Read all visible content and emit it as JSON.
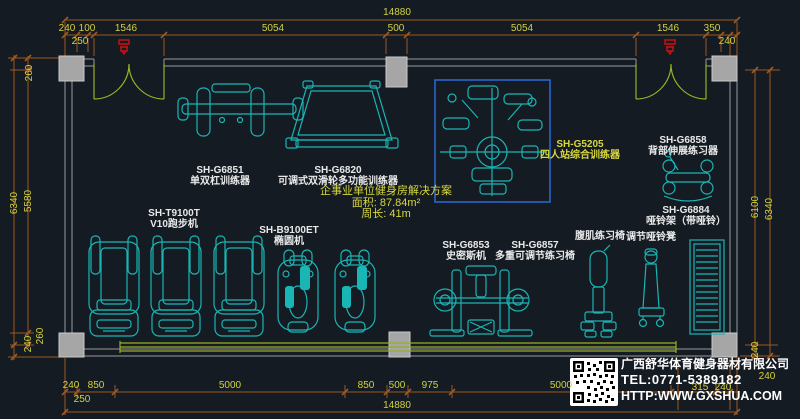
{
  "title": "企事业单位健身房平面布置图",
  "colors": {
    "bg": "#141b22",
    "cyan": "#1ab5b5",
    "green": "#96b124",
    "dimline": "#9e5a20",
    "dimtext": "#d2d23e",
    "wall": "#9a9a9a",
    "wallfill": "#a6a6a6",
    "blue": "#2b6bd7",
    "red": "#cc1111",
    "white": "#e9e9e9",
    "yellow": "#d8d83e"
  },
  "dims": {
    "top_total": "14880",
    "top_row": [
      "240",
      "100",
      "1546",
      "5054",
      "500",
      "5054",
      "1546",
      "350"
    ],
    "top_sub": [
      "250",
      "240"
    ],
    "left": [
      "260",
      "6340",
      "5580",
      "240",
      "260"
    ],
    "right": [
      "6100",
      "6340",
      "240",
      "240"
    ],
    "bottom_row": [
      "240",
      "850",
      "5000",
      "850",
      "500",
      "975",
      "5000",
      "315",
      "240"
    ],
    "bottom_sub": [
      "250"
    ],
    "bottom_total": "14880"
  },
  "solution": {
    "title": "企事业单位健身房解决方案",
    "area": "面积: 87.84m²",
    "perimeter": "周长: 41m"
  },
  "equipment": [
    {
      "model": "SH-G6851",
      "name": "单双杠训练器"
    },
    {
      "model": "SH-G6820",
      "name": "可调式双滑轮多功能训练器"
    },
    {
      "model": "SH-G5205",
      "name": "四人站综合训练器"
    },
    {
      "model": "SH-G6858",
      "name": "背部伸展练习器"
    },
    {
      "model": "SH-G6884",
      "name": "哑铃架（带哑铃）"
    },
    {
      "model": "SH-T9100T",
      "name": "V10跑步机"
    },
    {
      "model": "SH-B9100ET",
      "name": "椭圆机"
    },
    {
      "model": "SH-G6853",
      "name": "史密斯机"
    },
    {
      "model": "SH-G6857",
      "name": "多重可调节练习椅"
    },
    {
      "model": "",
      "name": "腹肌练习椅"
    },
    {
      "model": "",
      "name": "调节哑铃凳"
    }
  ],
  "company": {
    "name": "广西舒华体育健身器材有限公司",
    "tel": "TEL:0771-5389182",
    "web": "HTTP:WWW.GXSHUA.COM"
  }
}
